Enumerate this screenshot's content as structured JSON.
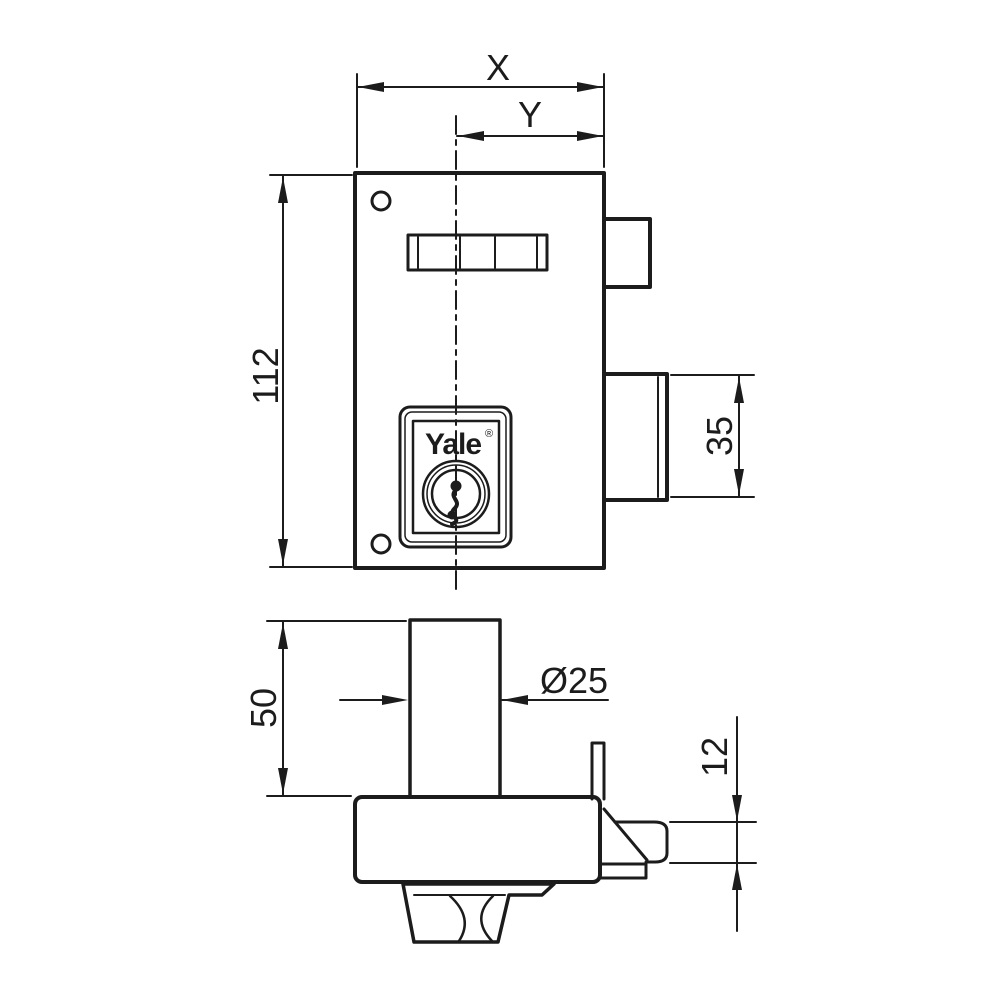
{
  "meta": {
    "background": "#ffffff",
    "line_color": "#1c1c1c",
    "drawing_type": "technical dimension drawing of rim lock"
  },
  "labels": {
    "dim_overall_width": "X",
    "dim_center_to_edge": "Y",
    "dim_body_height": "112",
    "dim_bolt_height": "35",
    "dim_cylinder_length": "50",
    "dim_cylinder_diameter": "Ø25",
    "dim_bolt_thickness": "12",
    "brand": "Yale",
    "registered_mark": "®"
  }
}
